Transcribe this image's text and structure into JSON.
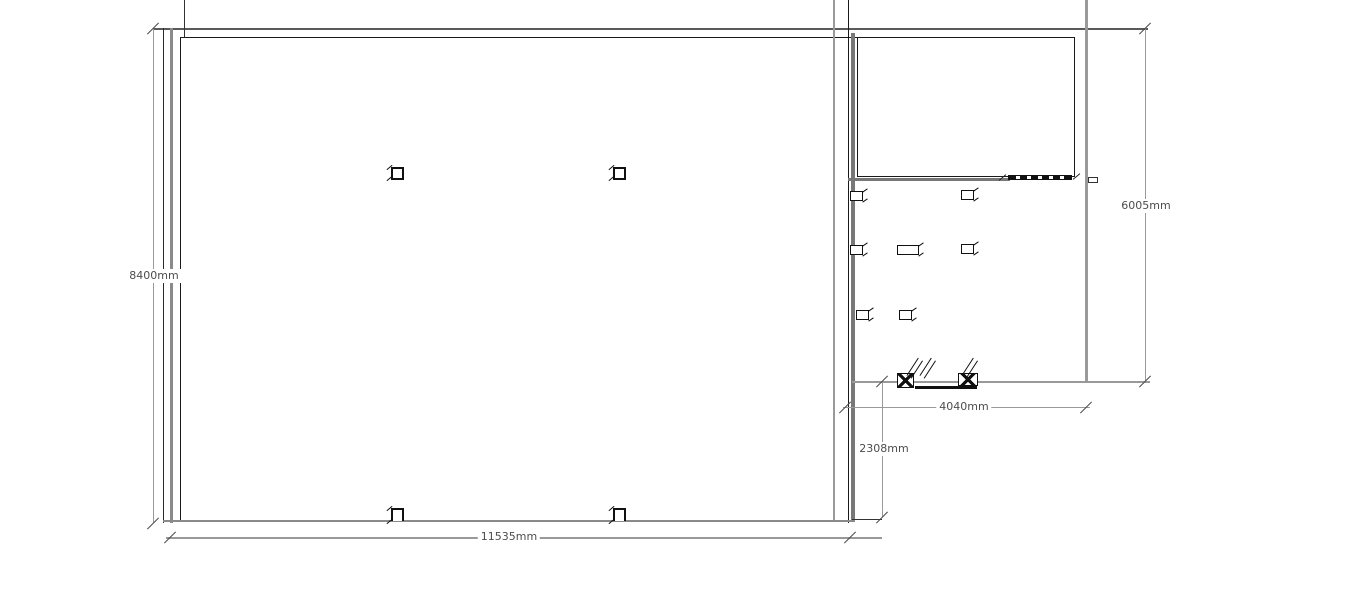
{
  "drawing": {
    "type": "floor-plan",
    "background": "#ffffff",
    "colors": {
      "wall_dark": "#1a1a1a",
      "wall_gray": "#8a8a8a",
      "wall_thick_gray": "#787878",
      "dimension_line": "#999999",
      "dimension_text": "#4d4d4d"
    },
    "dimensions": {
      "left": {
        "label": "8400mm",
        "orientation": "vertical"
      },
      "bottom": {
        "label": "11535mm",
        "orientation": "horizontal"
      },
      "right": {
        "label": "6005mm",
        "orientation": "vertical"
      },
      "annex_width": {
        "label": "4040mm",
        "orientation": "horizontal"
      },
      "annex_depth": {
        "label": "2308mm",
        "orientation": "vertical"
      }
    },
    "symbols": {
      "columns": 4,
      "chairs": 6,
      "tables": 1,
      "sliding_door": 1
    }
  }
}
